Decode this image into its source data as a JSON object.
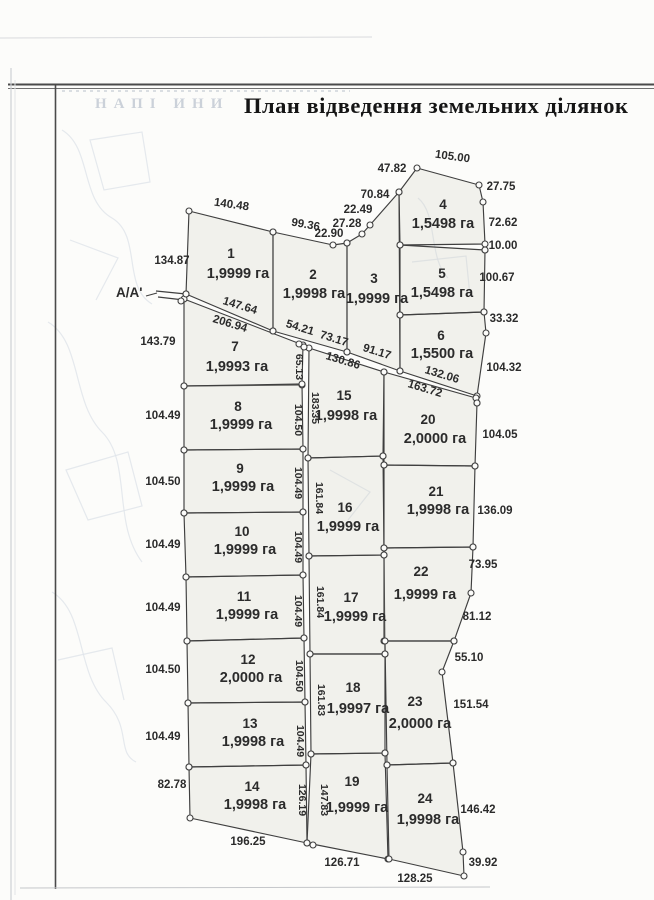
{
  "page": {
    "title": "План відведення земельних ділянок",
    "section_label": "А/А'",
    "bleedthrough_text": "НАПІ  ИНИ"
  },
  "style": {
    "parcel_fill": "rgba(208,207,197,0.25)",
    "line_color": "#3f3f3f",
    "label_color": "#2b2b2b",
    "vertex_fill": "#fcfcfa"
  },
  "plan": {
    "parcels": [
      {
        "number": "1",
        "area_label": "1,9999 га",
        "points": [
          [
            189,
            211
          ],
          [
            273,
            232
          ],
          [
            273,
            331
          ],
          [
            186,
            294
          ]
        ],
        "num_pos": [
          231,
          258
        ],
        "area_pos": [
          238,
          278
        ]
      },
      {
        "number": "2",
        "area_label": "1,9998 га",
        "points": [
          [
            273,
            232
          ],
          [
            333,
            245
          ],
          [
            347,
            243
          ],
          [
            347,
            352
          ],
          [
            273,
            331
          ]
        ],
        "num_pos": [
          313,
          279
        ],
        "area_pos": [
          314,
          298
        ]
      },
      {
        "number": "3",
        "area_label": "1,9999 га",
        "points": [
          [
            347,
            243
          ],
          [
            362,
            234
          ],
          [
            370,
            225
          ],
          [
            399,
            192
          ],
          [
            400,
            371
          ],
          [
            347,
            352
          ]
        ],
        "num_pos": [
          374,
          283
        ],
        "area_pos": [
          377,
          303
        ]
      },
      {
        "number": "4",
        "area_label": "1,5498 га",
        "points": [
          [
            399,
            192
          ],
          [
            417,
            168
          ],
          [
            479,
            185
          ],
          [
            483,
            202
          ],
          [
            485,
            244
          ],
          [
            400,
            245
          ]
        ],
        "num_pos": [
          443,
          209
        ],
        "area_pos": [
          443,
          228
        ]
      },
      {
        "number": "5",
        "area_label": "1,5498 га",
        "points": [
          [
            400,
            245
          ],
          [
            485,
            250
          ],
          [
            484,
            312
          ],
          [
            400,
            315
          ]
        ],
        "num_pos": [
          442,
          278
        ],
        "area_pos": [
          442,
          297
        ]
      },
      {
        "number": "6",
        "area_label": "1,5500 га",
        "points": [
          [
            400,
            315
          ],
          [
            484,
            312
          ],
          [
            486,
            333
          ],
          [
            477,
            396
          ],
          [
            400,
            371
          ]
        ],
        "num_pos": [
          441,
          340
        ],
        "area_pos": [
          442,
          358
        ]
      },
      {
        "number": "7",
        "area_label": "1,9993 га",
        "points": [
          [
            184,
            299
          ],
          [
            303,
            345
          ],
          [
            302,
            385
          ],
          [
            184,
            386
          ]
        ],
        "num_pos": [
          235,
          351
        ],
        "area_pos": [
          237,
          371
        ]
      },
      {
        "number": "8",
        "area_label": "1,9999 га",
        "points": [
          [
            184,
            386
          ],
          [
            302,
            384
          ],
          [
            303,
            449
          ],
          [
            184,
            450
          ]
        ],
        "num_pos": [
          238,
          411
        ],
        "area_pos": [
          241,
          429
        ]
      },
      {
        "number": "9",
        "area_label": "1,9999 га",
        "points": [
          [
            184,
            450
          ],
          [
            303,
            449
          ],
          [
            303,
            512
          ],
          [
            184,
            513
          ]
        ],
        "num_pos": [
          240,
          473
        ],
        "area_pos": [
          243,
          491
        ]
      },
      {
        "number": "10",
        "area_label": "1,9999 га",
        "points": [
          [
            184,
            513
          ],
          [
            303,
            512
          ],
          [
            303,
            575
          ],
          [
            186,
            577
          ]
        ],
        "num_pos": [
          242,
          536
        ],
        "area_pos": [
          245,
          554
        ]
      },
      {
        "number": "11",
        "area_label": "1,9999 га",
        "points": [
          [
            186,
            577
          ],
          [
            303,
            575
          ],
          [
            304,
            638
          ],
          [
            187,
            641
          ]
        ],
        "num_pos": [
          244,
          601
        ],
        "area_pos": [
          247,
          619
        ]
      },
      {
        "number": "12",
        "area_label": "2,0000 га",
        "points": [
          [
            187,
            641
          ],
          [
            304,
            638
          ],
          [
            305,
            702
          ],
          [
            188,
            703
          ]
        ],
        "num_pos": [
          248,
          664
        ],
        "area_pos": [
          251,
          682
        ]
      },
      {
        "number": "13",
        "area_label": "1,9998 га",
        "points": [
          [
            188,
            703
          ],
          [
            305,
            702
          ],
          [
            306,
            765
          ],
          [
            189,
            767
          ]
        ],
        "num_pos": [
          250,
          728
        ],
        "area_pos": [
          253,
          746
        ]
      },
      {
        "number": "14",
        "area_label": "1,9998 га",
        "points": [
          [
            189,
            767
          ],
          [
            306,
            765
          ],
          [
            307,
            843
          ],
          [
            190,
            818
          ]
        ],
        "num_pos": [
          252,
          791
        ],
        "area_pos": [
          255,
          809
        ]
      },
      {
        "number": "15",
        "area_label": "1,9998 га",
        "points": [
          [
            309,
            348
          ],
          [
            384,
            372
          ],
          [
            383,
            456
          ],
          [
            308,
            458
          ]
        ],
        "num_pos": [
          344,
          400
        ],
        "area_pos": [
          346,
          420
        ]
      },
      {
        "number": "16",
        "area_label": "1,9999 га",
        "points": [
          [
            308,
            458
          ],
          [
            383,
            456
          ],
          [
            384,
            555
          ],
          [
            309,
            556
          ]
        ],
        "num_pos": [
          345,
          512
        ],
        "area_pos": [
          348,
          531
        ]
      },
      {
        "number": "17",
        "area_label": "1,9999 га",
        "points": [
          [
            309,
            556
          ],
          [
            384,
            555
          ],
          [
            385,
            654
          ],
          [
            310,
            654
          ]
        ],
        "num_pos": [
          351,
          602
        ],
        "area_pos": [
          355,
          621
        ]
      },
      {
        "number": "18",
        "area_label": "1,9997 га",
        "points": [
          [
            310,
            654
          ],
          [
            385,
            654
          ],
          [
            385,
            753
          ],
          [
            311,
            754
          ]
        ],
        "num_pos": [
          353,
          692
        ],
        "area_pos": [
          358,
          713
        ]
      },
      {
        "number": "19",
        "area_label": "1,9999 га",
        "points": [
          [
            311,
            754
          ],
          [
            385,
            753
          ],
          [
            388,
            859
          ],
          [
            307,
            843
          ]
        ],
        "num_pos": [
          352,
          786
        ],
        "area_pos": [
          357,
          812
        ]
      },
      {
        "number": "20",
        "area_label": "2,0000 га",
        "points": [
          [
            384,
            372
          ],
          [
            476,
            398
          ],
          [
            477,
            403
          ],
          [
            475,
            466
          ],
          [
            384,
            465
          ]
        ],
        "num_pos": [
          428,
          424
        ],
        "area_pos": [
          435,
          443
        ]
      },
      {
        "number": "21",
        "area_label": "1,9998 га",
        "points": [
          [
            384,
            465
          ],
          [
            475,
            466
          ],
          [
            473,
            547
          ],
          [
            384,
            548
          ]
        ],
        "num_pos": [
          436,
          496
        ],
        "area_pos": [
          438,
          514
        ]
      },
      {
        "number": "22",
        "area_label": "1,9999 га",
        "points": [
          [
            384,
            548
          ],
          [
            473,
            547
          ],
          [
            471,
            593
          ],
          [
            454,
            641
          ],
          [
            384,
            641
          ]
        ],
        "num_pos": [
          421,
          576
        ],
        "area_pos": [
          425,
          599
        ]
      },
      {
        "number": "23",
        "area_label": "2,0000 га",
        "points": [
          [
            385,
            641
          ],
          [
            454,
            641
          ],
          [
            442,
            672
          ],
          [
            453,
            763
          ],
          [
            387,
            765
          ]
        ],
        "num_pos": [
          415,
          706
        ],
        "area_pos": [
          420,
          728
        ]
      },
      {
        "number": "24",
        "area_label": "1,9998 га",
        "points": [
          [
            387,
            765
          ],
          [
            453,
            763
          ],
          [
            463,
            852
          ],
          [
            464,
            876
          ],
          [
            389,
            859
          ]
        ],
        "num_pos": [
          425,
          803
        ],
        "area_pos": [
          428,
          824
        ]
      }
    ],
    "measurements": [
      {
        "t": "140.48",
        "x": 231,
        "y": 208,
        "r": 8
      },
      {
        "t": "134.87",
        "x": 172,
        "y": 264,
        "r": 0
      },
      {
        "t": "99.36",
        "x": 305,
        "y": 228,
        "r": 10
      },
      {
        "t": "22.90",
        "x": 329,
        "y": 237,
        "r": 0
      },
      {
        "t": "27.28",
        "x": 347,
        "y": 227,
        "r": 0
      },
      {
        "t": "22.49",
        "x": 358,
        "y": 213,
        "r": 0
      },
      {
        "t": "70.84",
        "x": 375,
        "y": 198,
        "r": 0
      },
      {
        "t": "47.82",
        "x": 392,
        "y": 172,
        "r": 0
      },
      {
        "t": "105.00",
        "x": 452,
        "y": 160,
        "r": 8
      },
      {
        "t": "27.75",
        "x": 501,
        "y": 190,
        "r": 0
      },
      {
        "t": "72.62",
        "x": 503,
        "y": 226,
        "r": 0
      },
      {
        "t": "10.00",
        "x": 503,
        "y": 249,
        "r": 0
      },
      {
        "t": "100.67",
        "x": 497,
        "y": 281,
        "r": 0
      },
      {
        "t": "33.32",
        "x": 504,
        "y": 322,
        "r": 0
      },
      {
        "t": "104.32",
        "x": 504,
        "y": 371,
        "r": 0
      },
      {
        "t": "143.79",
        "x": 158,
        "y": 345,
        "r": 0
      },
      {
        "t": "104.49",
        "x": 163,
        "y": 419,
        "r": 0
      },
      {
        "t": "104.50",
        "x": 163,
        "y": 485,
        "r": 0
      },
      {
        "t": "104.49",
        "x": 163,
        "y": 548,
        "r": 0
      },
      {
        "t": "104.49",
        "x": 163,
        "y": 611,
        "r": 0
      },
      {
        "t": "104.50",
        "x": 163,
        "y": 673,
        "r": 0
      },
      {
        "t": "104.49",
        "x": 163,
        "y": 740,
        "r": 0
      },
      {
        "t": "82.78",
        "x": 172,
        "y": 788,
        "r": 0
      },
      {
        "t": "196.25",
        "x": 248,
        "y": 845,
        "r": 0
      },
      {
        "t": "126.71",
        "x": 342,
        "y": 866,
        "r": 0
      },
      {
        "t": "128.25",
        "x": 415,
        "y": 882,
        "r": 0
      },
      {
        "t": "39.92",
        "x": 483,
        "y": 866,
        "r": 0
      },
      {
        "t": "146.42",
        "x": 478,
        "y": 813,
        "r": 0
      },
      {
        "t": "151.54",
        "x": 471,
        "y": 708,
        "r": 0
      },
      {
        "t": "55.10",
        "x": 469,
        "y": 661,
        "r": 0
      },
      {
        "t": "81.12",
        "x": 477,
        "y": 620,
        "r": 0
      },
      {
        "t": "73.95",
        "x": 483,
        "y": 568,
        "r": 0
      },
      {
        "t": "136.09",
        "x": 495,
        "y": 514,
        "r": 0
      },
      {
        "t": "104.05",
        "x": 500,
        "y": 438,
        "r": 0
      },
      {
        "t": "147.64",
        "x": 239,
        "y": 309,
        "r": 17
      },
      {
        "t": "206.94",
        "x": 229,
        "y": 327,
        "r": 17
      },
      {
        "t": "54.21",
        "x": 299,
        "y": 331,
        "r": 17
      },
      {
        "t": "73.17",
        "x": 333,
        "y": 342,
        "r": 17
      },
      {
        "t": "91.17",
        "x": 376,
        "y": 355,
        "r": 17
      },
      {
        "t": "130.86",
        "x": 342,
        "y": 364,
        "r": 17
      },
      {
        "t": "132.06",
        "x": 441,
        "y": 378,
        "r": 17
      },
      {
        "t": "163.72",
        "x": 424,
        "y": 392,
        "r": 17
      },
      {
        "t": "65.13",
        "x": 296,
        "y": 367,
        "r": 90
      },
      {
        "t": "183.35",
        "x": 312,
        "y": 408,
        "r": 90
      },
      {
        "t": "104.50",
        "x": 295,
        "y": 420,
        "r": 90
      },
      {
        "t": "104.49",
        "x": 295,
        "y": 483,
        "r": 90
      },
      {
        "t": "161.84",
        "x": 316,
        "y": 498,
        "r": 90
      },
      {
        "t": "104.49",
        "x": 295,
        "y": 547,
        "r": 90
      },
      {
        "t": "161.84",
        "x": 317,
        "y": 602,
        "r": 90
      },
      {
        "t": "104.49",
        "x": 295,
        "y": 611,
        "r": 90
      },
      {
        "t": "104.50",
        "x": 296,
        "y": 676,
        "r": 90
      },
      {
        "t": "161.83",
        "x": 318,
        "y": 700,
        "r": 90
      },
      {
        "t": "104.49",
        "x": 297,
        "y": 741,
        "r": 90
      },
      {
        "t": "126.19",
        "x": 299,
        "y": 800,
        "r": 90
      },
      {
        "t": "147.83",
        "x": 321,
        "y": 800,
        "r": 90
      }
    ],
    "extra_lines": [
      [
        156,
        291,
        186,
        294
      ],
      [
        158,
        297,
        184,
        300
      ],
      [
        303,
        345,
        309,
        348
      ],
      [
        146,
        296,
        157,
        293
      ]
    ],
    "extra_circles": [
      [
        181,
        301
      ],
      [
        186,
        294
      ],
      [
        485,
        250
      ],
      [
        477,
        403
      ],
      [
        313,
        845
      ],
      [
        299,
        344
      ],
      [
        304,
        347
      ]
    ],
    "frame_lines": [
      {
        "x1": 8,
        "y1": 84.5,
        "x2": 654,
        "y2": 84.5,
        "w": 2,
        "c": "#4a4a4a"
      },
      {
        "x1": 8,
        "y1": 88.5,
        "x2": 654,
        "y2": 88.5,
        "w": 1,
        "c": "#6f6f6f"
      },
      {
        "x1": 55.5,
        "y1": 85,
        "x2": 55.5,
        "y2": 889,
        "w": 1.6,
        "c": "#4a4a4a"
      },
      {
        "x1": 11,
        "y1": 68,
        "x2": 11,
        "y2": 900,
        "w": 1.2,
        "c": "#cdd0d4"
      },
      {
        "x1": 15,
        "y1": 80,
        "x2": 15,
        "y2": 895,
        "w": 1,
        "c": "#e2e4e7"
      },
      {
        "x1": 0,
        "y1": 38,
        "x2": 372,
        "y2": 37,
        "w": 1,
        "c": "#d9dadd"
      },
      {
        "x1": 20,
        "y1": 888,
        "x2": 490,
        "y2": 887,
        "w": 1,
        "c": "#c5c7ca"
      },
      {
        "x1": 62,
        "y1": 91,
        "x2": 350,
        "y2": 91,
        "w": 1.5,
        "c": "#cfd3d9",
        "dash": "3 4"
      }
    ],
    "decor_paths": [
      "M62,130 C92,148 80,200 112,218 C142,236 122,286 152,304",
      "M48,322 C82,342 72,402 102,432 C132,462 112,522 142,562",
      "M52,592 C86,612 76,672 106,702 C132,728 116,752 136,762",
      "M90,140 L142,132 L150,182 L104,190 Z",
      "M70,240 L118,258 L96,300",
      "M66,470 L128,452 L142,506 L88,520 Z",
      "M58,660 L112,648 L124,700",
      "M418,198 C438,214 428,258 448,278",
      "M412,262 L466,256 L470,296",
      "M330,470 L370,492 L348,520"
    ]
  }
}
